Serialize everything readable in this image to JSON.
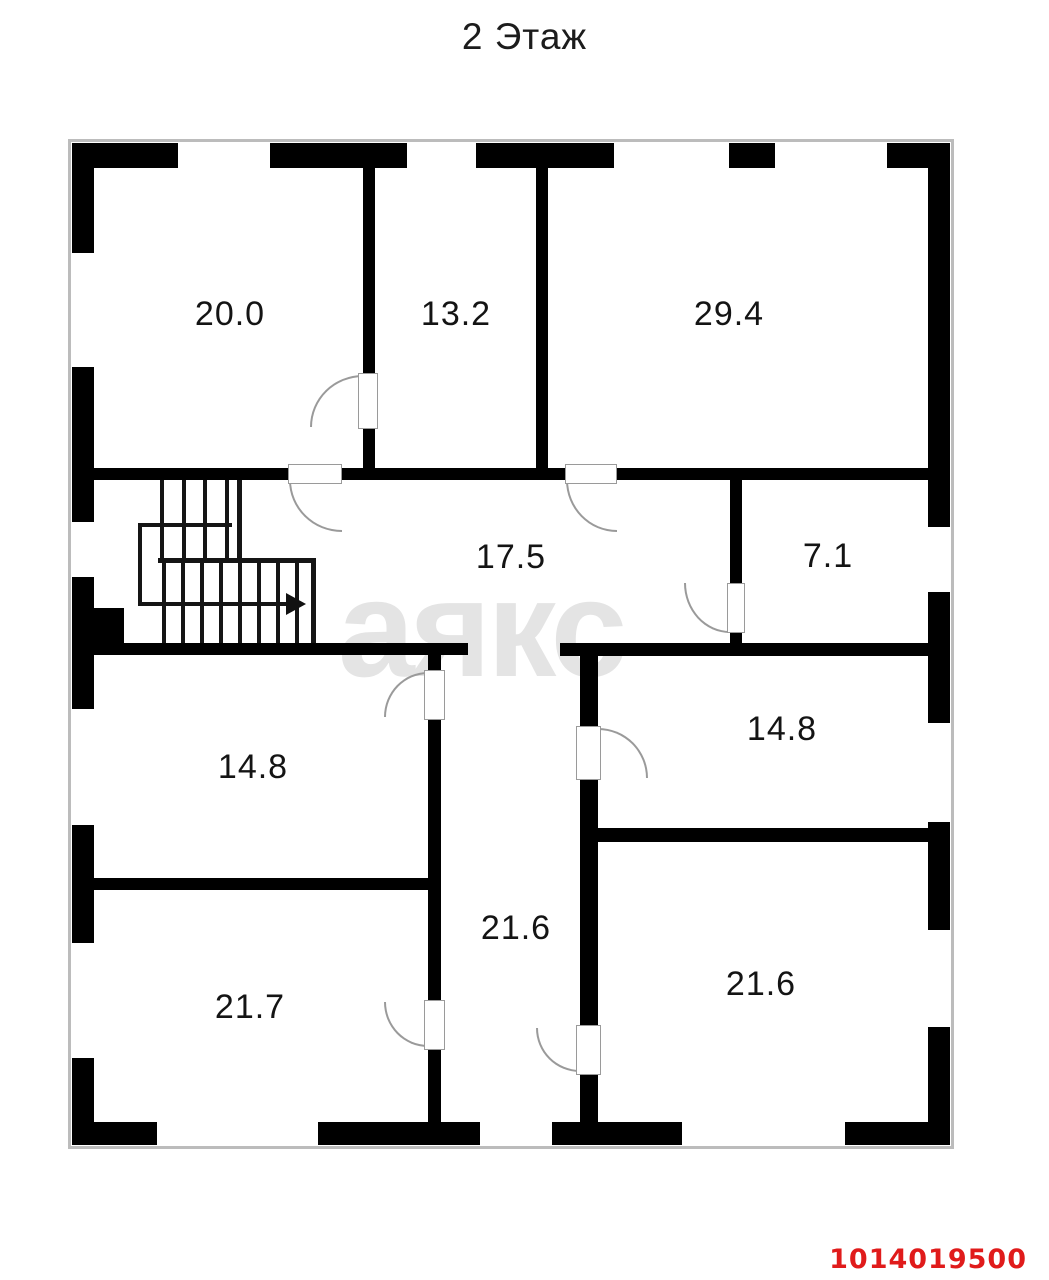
{
  "title": "2 Этаж",
  "watermark_text": "аякс",
  "listing_id": "1014019500",
  "colors": {
    "background": "#ffffff",
    "walls": "#000000",
    "listing_id_red": "#e01b1b",
    "watermark_gray": "#e4e4e4",
    "door_line_gray": "#9a9a9a",
    "frame_line_gray": "#bcbcbc"
  },
  "rooms": [
    {
      "name": "room-top-left",
      "label": "20.0"
    },
    {
      "name": "room-top-middle",
      "label": "13.2"
    },
    {
      "name": "room-top-right",
      "label": "29.4"
    },
    {
      "name": "hallway",
      "label": "17.5"
    },
    {
      "name": "room-small-right",
      "label": "7.1"
    },
    {
      "name": "room-mid-left",
      "label": "14.8"
    },
    {
      "name": "room-mid-right",
      "label": "14.8"
    },
    {
      "name": "corridor-center",
      "label": "21.6"
    },
    {
      "name": "room-bottom-left",
      "label": "21.7"
    },
    {
      "name": "room-bottom-right",
      "label": "21.6"
    }
  ]
}
